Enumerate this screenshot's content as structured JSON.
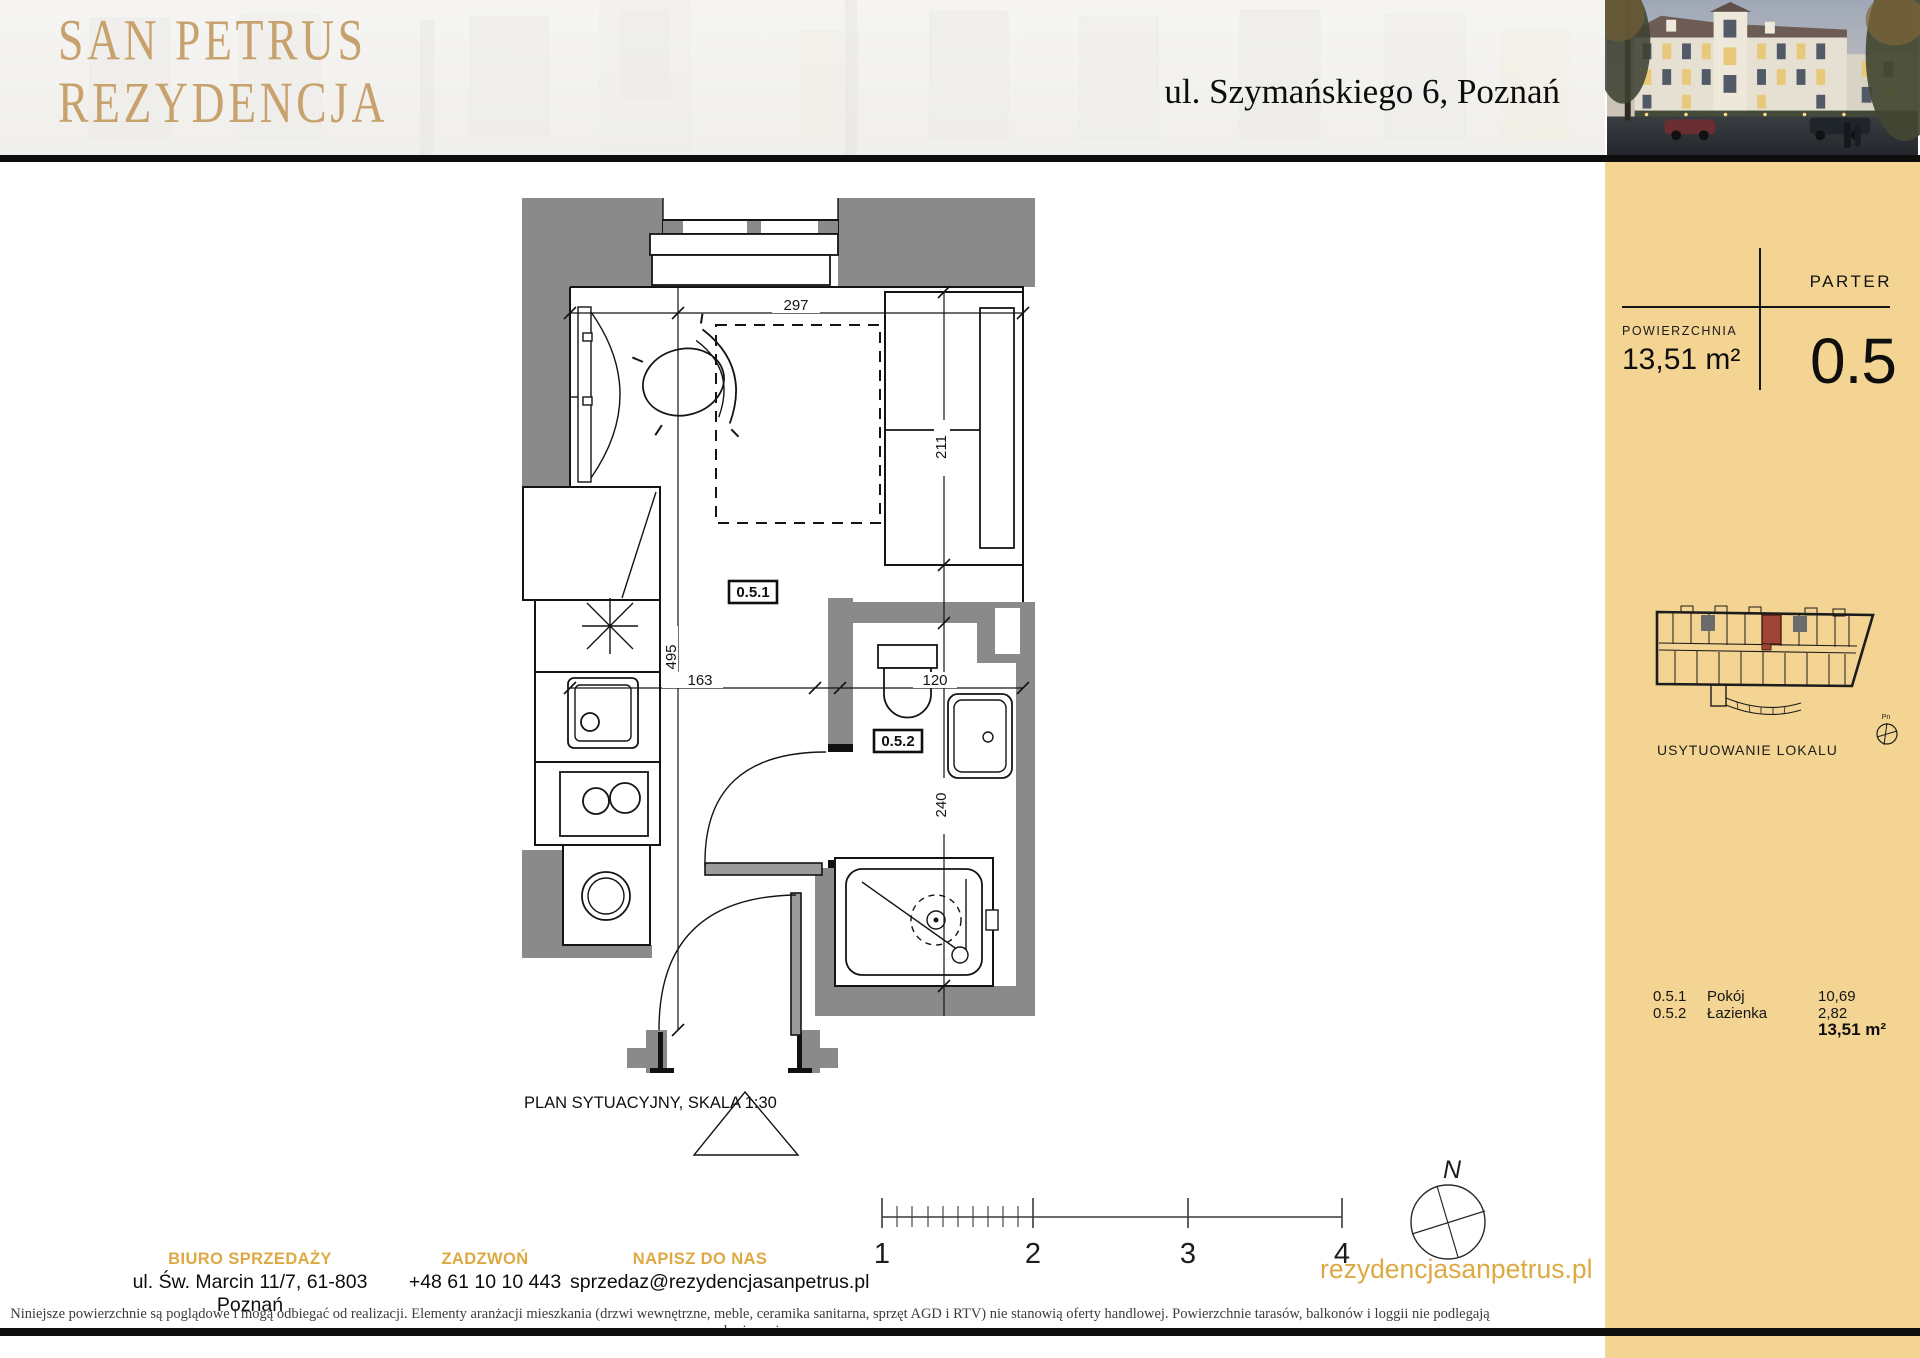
{
  "header": {
    "logo_line1": "SAN PETRUS",
    "logo_line2": "REZYDENCJA",
    "address": "ul. Szymańskiego 6, Poznań"
  },
  "sidebar": {
    "floor_label": "PARTER",
    "area_label": "POWIERZCHNIA",
    "area_value": "13,51 m²",
    "unit_number": "0.5",
    "location_label": "USYTUOWANIE LOKALU",
    "mini_compass_label": "Pn",
    "rooms": [
      {
        "code": "0.5.1",
        "name": "Pokój",
        "area": "10,69"
      },
      {
        "code": "0.5.2",
        "name": "Łazienka",
        "area": "2,82"
      }
    ],
    "total_area": "13,51 m²"
  },
  "plan": {
    "caption": "PLAN SYTUACYJNY, SKALA 1:30",
    "room1_label": "0.5.1",
    "room2_label": "0.5.2",
    "dim_width": "297",
    "dim_bed": "211",
    "dim_height": "495",
    "dim_hall": "163",
    "dim_bath_w": "120",
    "dim_bath_h": "240"
  },
  "scale_bar": {
    "labels": [
      "1",
      "2",
      "3",
      "4"
    ]
  },
  "compass": {
    "label": "N"
  },
  "footer": {
    "columns": [
      {
        "title": "BIURO SPRZEDAŻY",
        "value": "ul. Św. Marcin 11/7, 61-803 Poznań"
      },
      {
        "title": "ZADZWOŃ",
        "value": "+48 61 10 10 443"
      },
      {
        "title": "NAPISZ DO NAS",
        "value": "sprzedaz@rezydencjasanpetrus.pl"
      }
    ],
    "website": "rezydencjasanpetrus.pl"
  },
  "disclaimer": "Niniejsze powierzchnie są poglądowe i mogą odbiegać od realizacji. Elementy aranżacji mieszkania (drzwi wewnętrzne, meble, ceramika sanitarna, sprzęt AGD i RTV) nie stanowią oferty handlowej. Powierzchnie tarasów, balkonów i loggii nie podlegają obmiarowi.",
  "colors": {
    "gold": "#dda943",
    "logo_gold": "#c59c63",
    "tan": "#f3d492",
    "wall": "#8a8a8a",
    "red": "#a04438",
    "line": "#141414"
  }
}
